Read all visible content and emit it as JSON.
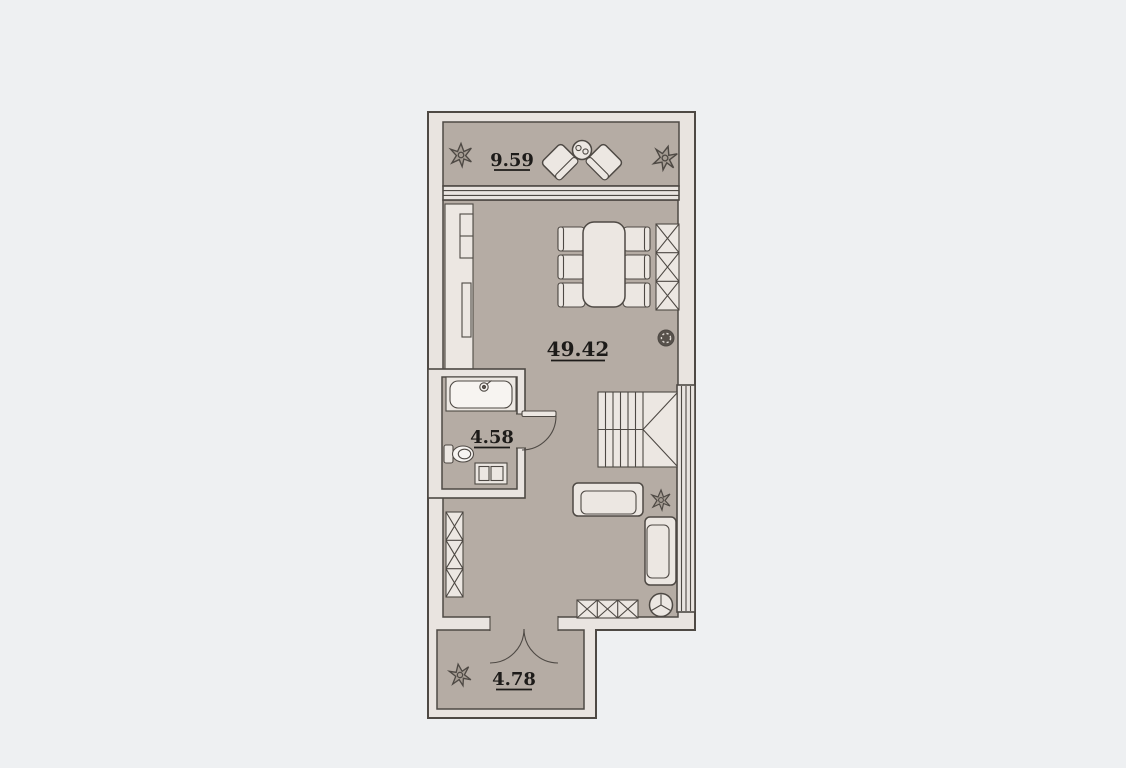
{
  "plan": {
    "type": "apartment-floor-plan",
    "rooms": [
      {
        "name": "terrace",
        "area_label": "9.59"
      },
      {
        "name": "living-room",
        "area_label": "49.42"
      },
      {
        "name": "bathroom",
        "area_label": "4.58"
      },
      {
        "name": "entry-hall",
        "area_label": "4.78"
      }
    ],
    "colors": {
      "background": "#eef0f2",
      "wall_fill": "#e9e4e0",
      "floor_fill": "#b5aca4",
      "furniture_fill": "#ece7e2",
      "fixture_white": "#f7f4f1",
      "line": "#4e4944",
      "text": "#1d1b19"
    }
  }
}
